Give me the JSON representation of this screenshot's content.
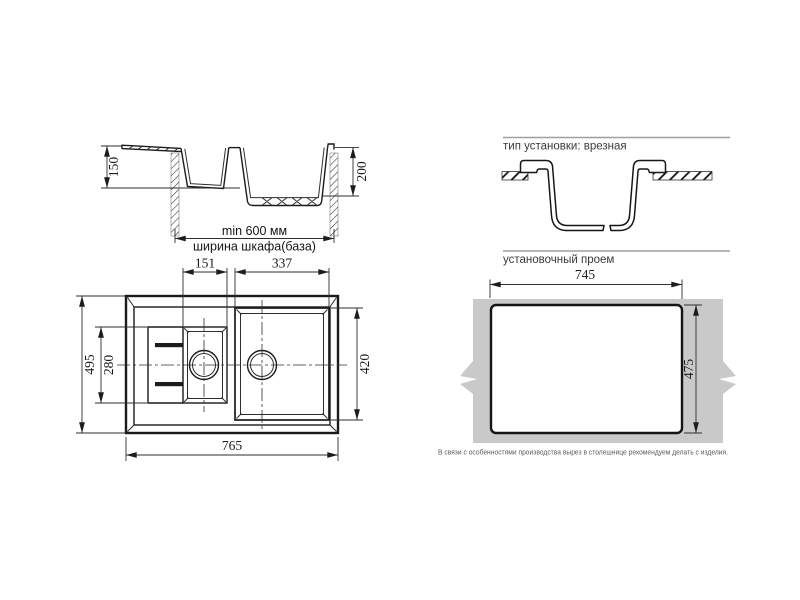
{
  "side_view": {
    "depth_small_bowl": "150",
    "depth_main_bowl": "200",
    "min_cabinet_width": "min 600 мм",
    "cabinet_width_label": "ширина шкафа(база)"
  },
  "top_view": {
    "small_bowl_width": "151",
    "main_bowl_width": "337",
    "overall_depth": "495",
    "small_bowl_length": "280",
    "main_bowl_length": "420",
    "overall_width": "765"
  },
  "installation": {
    "type_title": "тип установки: врезная",
    "opening_title": "установочный проем",
    "cutout_width": "745",
    "cutout_height": "475",
    "note": "В связи с особенностями производства вырез в столешнице рекомендуем делать с изделия."
  },
  "colors": {
    "line": "#1b1b1b",
    "rule": "#9f9f9f",
    "countertop": "#c9c9c9",
    "note_text": "#5a5a5a"
  }
}
